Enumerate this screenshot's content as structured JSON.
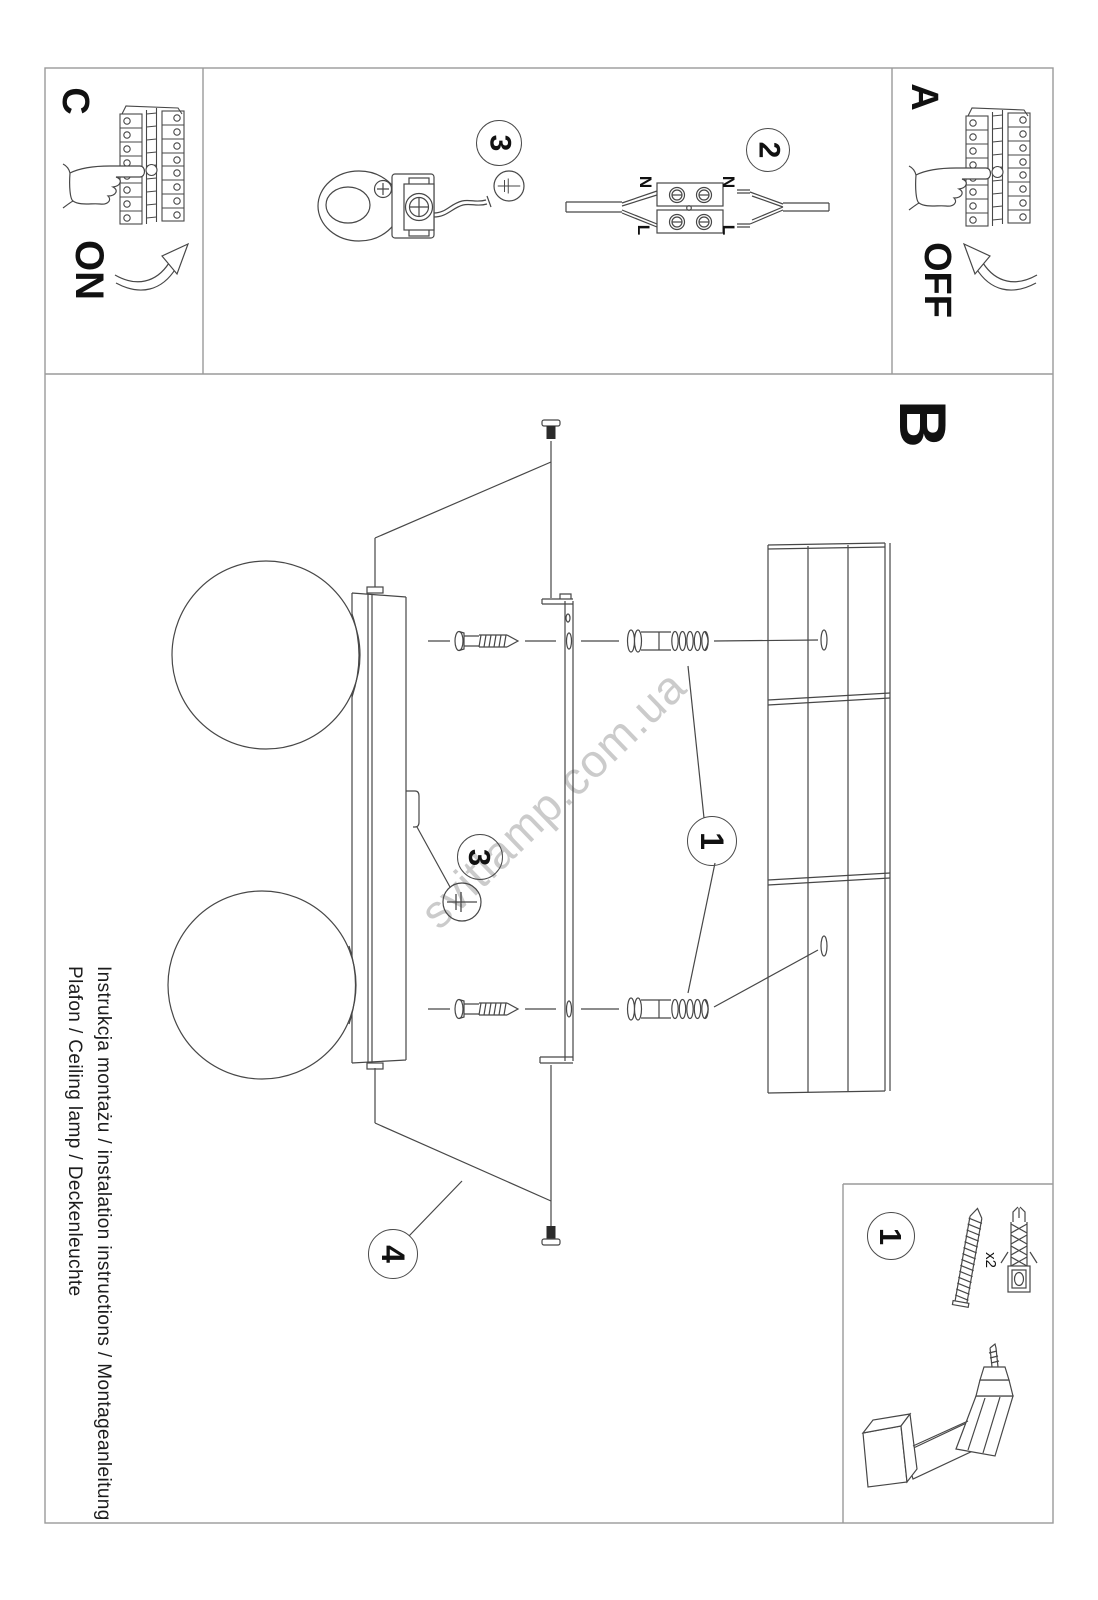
{
  "document": {
    "side_text_line1": "Instrukcja montażu / instalation instructions / Montageanleitung",
    "side_text_line2": "Plafon / Ceiling lamp / Deckenleuchte",
    "watermark": "svitlamp.com.ua"
  },
  "panels": {
    "a": {
      "label": "A",
      "switch_state": "OFF"
    },
    "b": {
      "label": "B"
    },
    "c": {
      "label": "C",
      "switch_state": "ON"
    }
  },
  "callouts": {
    "clamp_step": "3",
    "wiring_step": "2",
    "hook_step": "3",
    "anchor_step": "1",
    "final_step": "4",
    "kit_step": "1"
  },
  "wiring_labels": {
    "n_left": "N",
    "n_right": "N",
    "l_left": "L",
    "l_right": "L"
  },
  "kit": {
    "anchor_qty": "x2"
  },
  "colors": {
    "line": "#474747",
    "border": "#9a9a9a",
    "watermark": "#cbcbcb"
  }
}
